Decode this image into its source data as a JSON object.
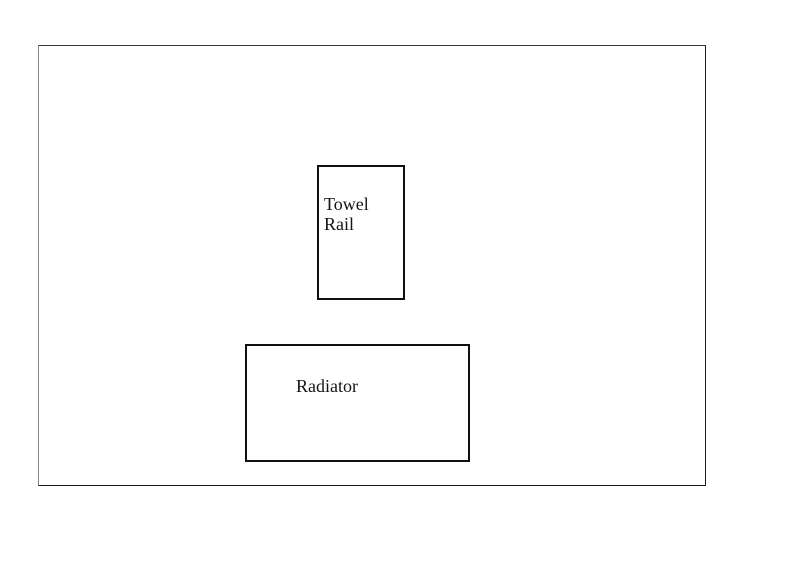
{
  "diagram": {
    "background_color": "#ffffff",
    "outline_color": "#3c3c3c",
    "box_border_color": "#101010",
    "text_color": "#141414",
    "boxes": [
      {
        "id": "towel-rail",
        "label": "Towel Rail"
      },
      {
        "id": "radiator",
        "label": "Radiator"
      }
    ]
  }
}
